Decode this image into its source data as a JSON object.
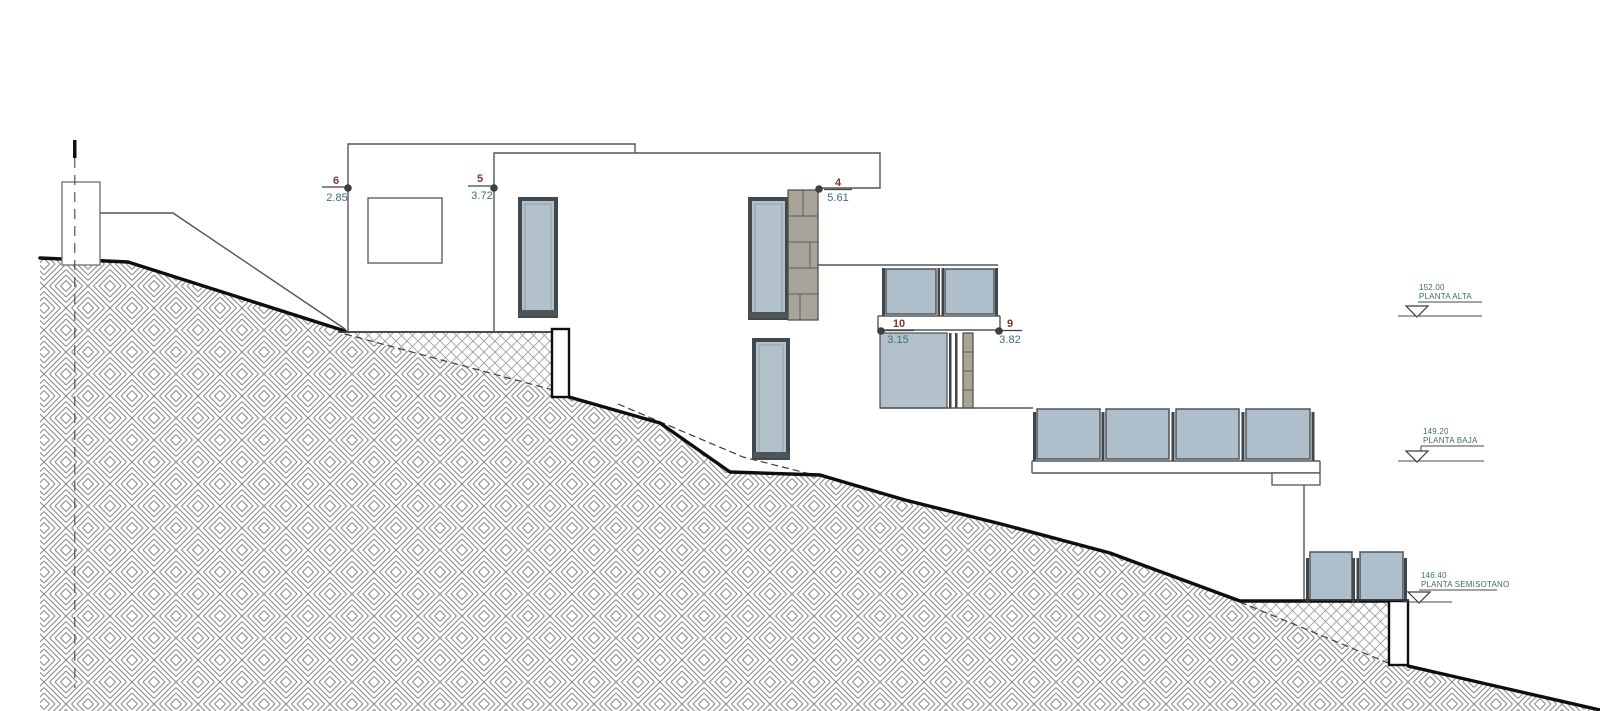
{
  "drawing": {
    "type": "architectural-section-elevation",
    "dim_markers": [
      {
        "number": "6",
        "value": "2.85"
      },
      {
        "number": "5",
        "value": "3.72"
      },
      {
        "number": "4",
        "value": "5.61"
      },
      {
        "number": "10",
        "value": "3.15"
      },
      {
        "number": "9",
        "value": "3.82"
      }
    ],
    "levels": [
      {
        "elevation": "152.00",
        "label": "PLANTA ALTA"
      },
      {
        "elevation": "149.20",
        "label": "PLANTA BAJA"
      },
      {
        "elevation": "146.40",
        "label": "PLANTA SEMISOTANO"
      }
    ],
    "colors": {
      "paper": "#ffffff",
      "terrain_hatch_line": "#8c8c8c",
      "light_hatch_line": "#a0a0a0",
      "profile_line": "#0e0e0e",
      "drawing_line": "#555555",
      "glass": "#aebecb",
      "window_frame": "#41484e",
      "stone": "#a9a499",
      "dim_number": "#7d372c",
      "dim_value": "#40707c",
      "level_text": "#3a6f63"
    }
  }
}
